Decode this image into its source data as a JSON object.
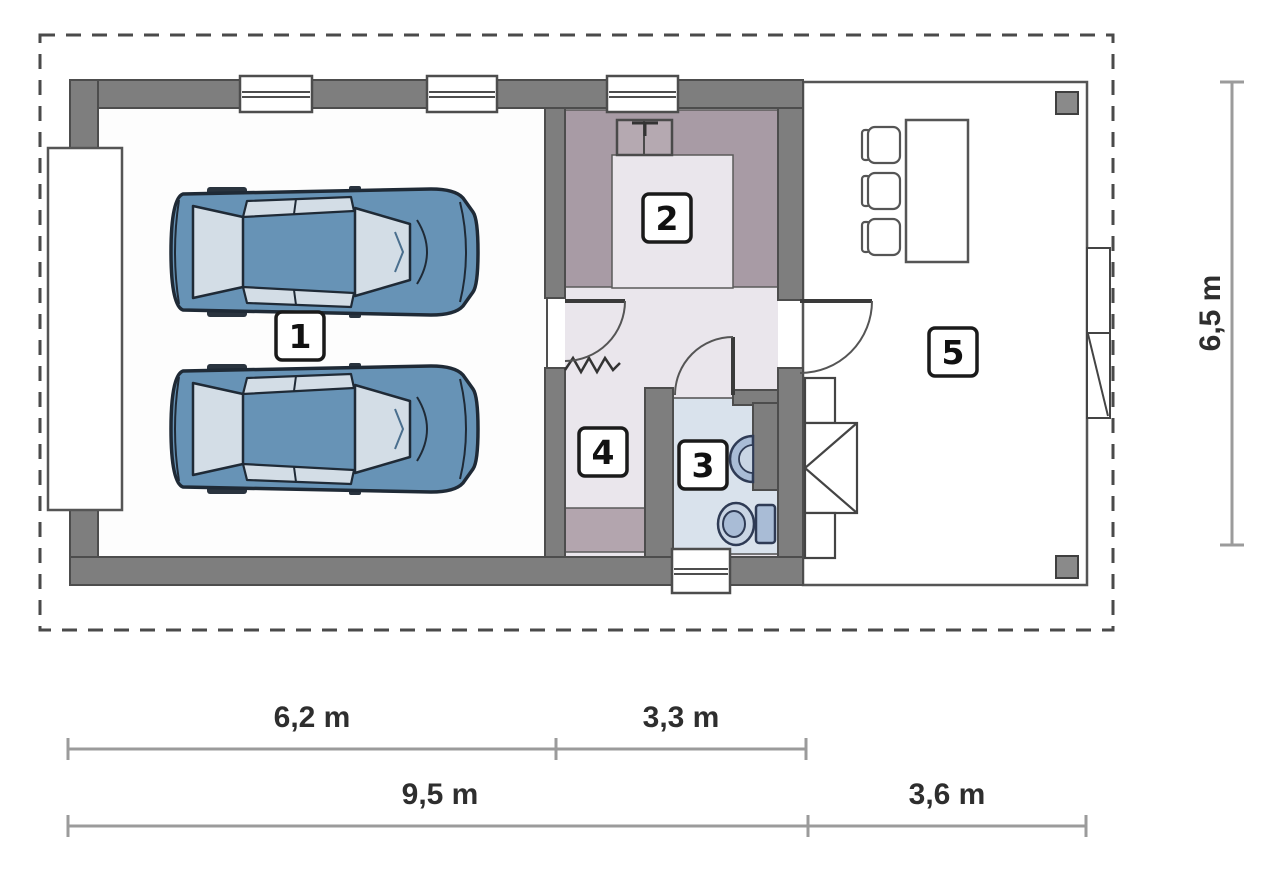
{
  "rooms": {
    "r1": "1",
    "r2": "2",
    "r3": "3",
    "r4": "4",
    "r5": "5"
  },
  "dimensions": {
    "garage_width": "6,2 m",
    "annex_width": "3,3 m",
    "building_width": "9,5 m",
    "terrace_width": "3,6 m",
    "building_depth": "6,5 m"
  },
  "colors": {
    "wall_gray": "#7e7e7e",
    "floor_light": "#eae6ec",
    "floor_mauve": "#a89ba5",
    "counter_mauve": "#b3a5ae",
    "floor_bath": "#d9e2ec",
    "fixture_blue": "#a9bcd6",
    "fixture_blue_light": "#c9d5e4",
    "car_body": "#6793b6",
    "car_window": "#d3dde6",
    "car_outline": "#1f2a36",
    "dimension_line": "#9b9b9b",
    "plot_dash": "#4a4a4a"
  }
}
